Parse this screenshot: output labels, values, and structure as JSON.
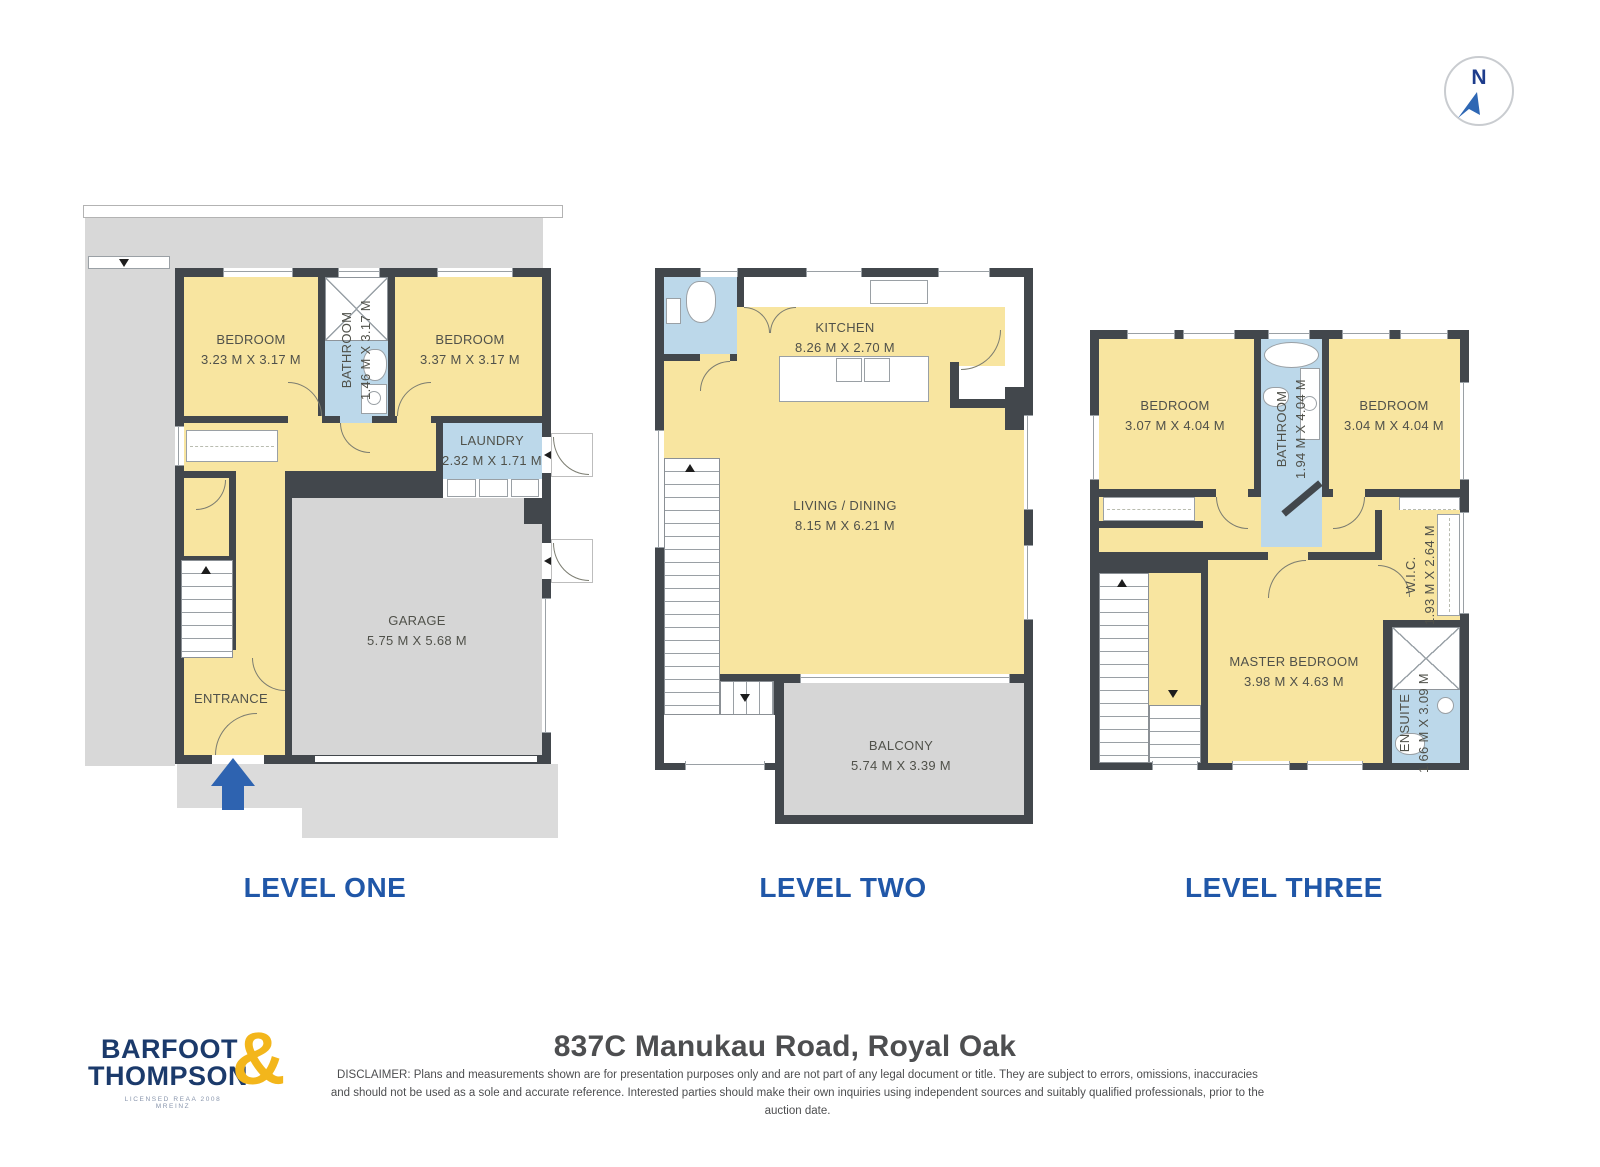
{
  "header": {
    "compass_label": "N"
  },
  "levels": [
    {
      "label": "LEVEL ONE",
      "rooms": [
        {
          "name": "BEDROOM",
          "dims": "3.23 M X 3.17 M"
        },
        {
          "name": "BATHROOM",
          "dims": "1.46 M X 3.17 M"
        },
        {
          "name": "BEDROOM",
          "dims": "3.37 M X 3.17 M"
        },
        {
          "name": "LAUNDRY",
          "dims": "2.32 M X 1.71 M"
        },
        {
          "name": "GARAGE",
          "dims": "5.75 M X 5.68 M"
        },
        {
          "name": "ENTRANCE",
          "dims": ""
        }
      ]
    },
    {
      "label": "LEVEL TWO",
      "rooms": [
        {
          "name": "KITCHEN",
          "dims": "8.26 M X 2.70 M"
        },
        {
          "name": "LIVING / DINING",
          "dims": "8.15 M X 6.21 M"
        },
        {
          "name": "BALCONY",
          "dims": "5.74 M X 3.39 M"
        }
      ]
    },
    {
      "label": "LEVEL THREE",
      "rooms": [
        {
          "name": "BEDROOM",
          "dims": "3.07 M X 4.04 M"
        },
        {
          "name": "BATHROOM",
          "dims": "1.94 M X 4.04 M"
        },
        {
          "name": "BEDROOM",
          "dims": "3.04 M X 4.04 M"
        },
        {
          "name": "W.I.C.",
          "dims": "1.93 M X 2.64 M"
        },
        {
          "name": "MASTER BEDROOM",
          "dims": "3.98 M X 4.63 M"
        },
        {
          "name": "ENSUITE",
          "dims": "1.66 M X 3.09 M"
        }
      ]
    }
  ],
  "footer": {
    "logo": {
      "line1": "BARFOOT",
      "line2": "THOMPSON",
      "ampersand": "&",
      "tagline": "LICENSED REAA 2008 MREINZ"
    },
    "address": "837C Manukau Road, Royal Oak",
    "disclaimer": "DISCLAIMER: Plans and measurements shown are for presentation purposes only and are not part of any legal document or title. They are subject to errors, omissions, inaccuracies and should not be used as a sole and accurate reference. Interested parties should make their own inquiries using independent sources and suitably qualified professionals, prior to the auction date."
  },
  "colors": {
    "room_yellow": "#F8E5A0",
    "wet_blue": "#BCD8EA",
    "deck_gray": "#D7D7D7",
    "wall_dark": "#42474C",
    "accent_blue": "#2057A8",
    "logo_navy": "#1B3A6B",
    "logo_gold": "#F3B61B"
  }
}
